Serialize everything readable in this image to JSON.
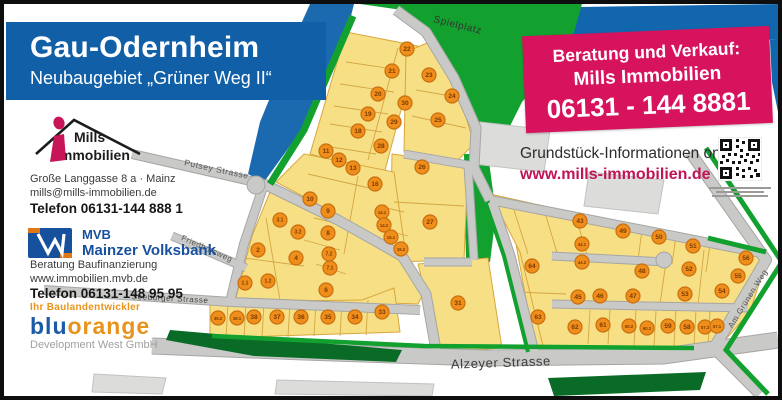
{
  "header": {
    "title": "Gau-Odernheim",
    "subtitle": "Neubaugebiet „Grüner Weg II“"
  },
  "mills": {
    "brand_top": "Mills",
    "brand_bottom": "Immobilien",
    "address": "Große Langgasse 8 a · Mainz",
    "email": "mills@mills-immobilien.de",
    "phone": "Telefon 06131-144 888 1"
  },
  "mvb": {
    "abbr": "MVB",
    "name": "Mainzer Volksbank",
    "line1": "Beratung Baufinanzierung",
    "line2": "www.immobilien.mvb.de",
    "phone": "Telefon 06131-148 95 95"
  },
  "bluorange": {
    "tagline": "Ihr Baulandentwickler",
    "brand_blue": "blu",
    "brand_orange": "orange",
    "subline": "Development West GmbH"
  },
  "contact_box": {
    "line1": "Beratung und Verkauf:",
    "line2": "Mills Immobilien",
    "phone": "06131 - 144 8881"
  },
  "online_info": {
    "line1": "Grundstück-Informationen online:",
    "line2": "www.mills-immobilien.de"
  },
  "map": {
    "colors": {
      "plot_fill": "#f7df85",
      "plot_border": "#d8a73e",
      "marker": "#ef8e1b",
      "marker_border": "#c96f0e",
      "marker_text": "#7c3a02",
      "green": "#12a12e",
      "dark_green": "#0a6b26",
      "road": "#c9c9c7",
      "road_casing": "#a6a6a4",
      "blue": "#1266ad",
      "gray_block": "#dcdcda"
    },
    "streets": [
      {
        "t": "Spielplatz",
        "x": 453,
        "y": 24,
        "r": 14,
        "s": 10,
        "c": "#333333"
      },
      {
        "t": "Putsey Strasse",
        "x": 212,
        "y": 168,
        "r": 12,
        "s": 8.5,
        "c": "#555555"
      },
      {
        "t": "Friedhofsweg",
        "x": 202,
        "y": 247,
        "r": 24,
        "s": 8,
        "c": "#555555"
      },
      {
        "t": "Seeburger Strasse",
        "x": 166,
        "y": 297,
        "r": 3,
        "s": 8,
        "c": "#444444"
      },
      {
        "t": "Alzeyer Strasse",
        "x": 497,
        "y": 363,
        "r": -2,
        "s": 13,
        "c": "#3d3d3d"
      },
      {
        "t": "Am Grünen Weg",
        "x": 746,
        "y": 296,
        "r": -58,
        "s": 8,
        "c": "#555555"
      }
    ],
    "plots": [
      {
        "n": "22",
        "x": 403,
        "y": 45
      },
      {
        "n": "21",
        "x": 388,
        "y": 67
      },
      {
        "n": "20",
        "x": 374,
        "y": 90
      },
      {
        "n": "19",
        "x": 364,
        "y": 110
      },
      {
        "n": "18",
        "x": 354,
        "y": 127
      },
      {
        "n": "30",
        "x": 401,
        "y": 99
      },
      {
        "n": "29",
        "x": 390,
        "y": 118
      },
      {
        "n": "28",
        "x": 377,
        "y": 142
      },
      {
        "n": "23",
        "x": 425,
        "y": 71
      },
      {
        "n": "24",
        "x": 448,
        "y": 92
      },
      {
        "n": "25",
        "x": 434,
        "y": 116
      },
      {
        "n": "26",
        "x": 418,
        "y": 163
      },
      {
        "n": "27",
        "x": 426,
        "y": 218
      },
      {
        "n": "11",
        "x": 322,
        "y": 147
      },
      {
        "n": "12",
        "x": 335,
        "y": 156
      },
      {
        "n": "13",
        "x": 349,
        "y": 164
      },
      {
        "n": "16",
        "x": 371,
        "y": 180
      },
      {
        "n": "10",
        "x": 306,
        "y": 195
      },
      {
        "n": "9",
        "x": 324,
        "y": 207
      },
      {
        "n": "14.1",
        "x": 378,
        "y": 208
      },
      {
        "n": "14.2",
        "x": 380,
        "y": 221
      },
      {
        "n": "15.1",
        "x": 387,
        "y": 233
      },
      {
        "n": "15.2",
        "x": 397,
        "y": 245
      },
      {
        "n": "8",
        "x": 324,
        "y": 229
      },
      {
        "n": "7.2",
        "x": 325,
        "y": 250
      },
      {
        "n": "7.1",
        "x": 326,
        "y": 264
      },
      {
        "n": "6",
        "x": 322,
        "y": 286
      },
      {
        "n": "3.1",
        "x": 276,
        "y": 216
      },
      {
        "n": "3.2",
        "x": 294,
        "y": 228
      },
      {
        "n": "2",
        "x": 254,
        "y": 246
      },
      {
        "n": "4",
        "x": 292,
        "y": 254
      },
      {
        "n": "1.1",
        "x": 241,
        "y": 279
      },
      {
        "n": "1.2",
        "x": 264,
        "y": 277
      },
      {
        "n": "39.2",
        "x": 214,
        "y": 314
      },
      {
        "n": "39.1",
        "x": 233,
        "y": 314
      },
      {
        "n": "38",
        "x": 250,
        "y": 313
      },
      {
        "n": "37",
        "x": 273,
        "y": 313
      },
      {
        "n": "36",
        "x": 297,
        "y": 313
      },
      {
        "n": "35",
        "x": 324,
        "y": 313
      },
      {
        "n": "34",
        "x": 351,
        "y": 313
      },
      {
        "n": "33",
        "x": 378,
        "y": 308
      },
      {
        "n": "31",
        "x": 454,
        "y": 299
      },
      {
        "n": "64",
        "x": 528,
        "y": 262
      },
      {
        "n": "63",
        "x": 534,
        "y": 313
      },
      {
        "n": "43",
        "x": 576,
        "y": 217
      },
      {
        "n": "44.1",
        "x": 578,
        "y": 240
      },
      {
        "n": "44.2",
        "x": 578,
        "y": 258
      },
      {
        "n": "45",
        "x": 574,
        "y": 293
      },
      {
        "n": "46",
        "x": 596,
        "y": 292
      },
      {
        "n": "49",
        "x": 619,
        "y": 227
      },
      {
        "n": "50",
        "x": 655,
        "y": 233
      },
      {
        "n": "51",
        "x": 689,
        "y": 242
      },
      {
        "n": "48",
        "x": 638,
        "y": 267
      },
      {
        "n": "52",
        "x": 685,
        "y": 265
      },
      {
        "n": "56",
        "x": 742,
        "y": 254
      },
      {
        "n": "55",
        "x": 734,
        "y": 272
      },
      {
        "n": "47",
        "x": 629,
        "y": 292
      },
      {
        "n": "53",
        "x": 681,
        "y": 290
      },
      {
        "n": "54",
        "x": 718,
        "y": 287
      },
      {
        "n": "62",
        "x": 571,
        "y": 323
      },
      {
        "n": "61",
        "x": 599,
        "y": 321
      },
      {
        "n": "60.2",
        "x": 625,
        "y": 322
      },
      {
        "n": "60.1",
        "x": 643,
        "y": 324
      },
      {
        "n": "59",
        "x": 664,
        "y": 322
      },
      {
        "n": "58",
        "x": 683,
        "y": 323
      },
      {
        "n": "57.2",
        "x": 701,
        "y": 323
      },
      {
        "n": "57.1",
        "x": 713,
        "y": 322
      }
    ]
  }
}
